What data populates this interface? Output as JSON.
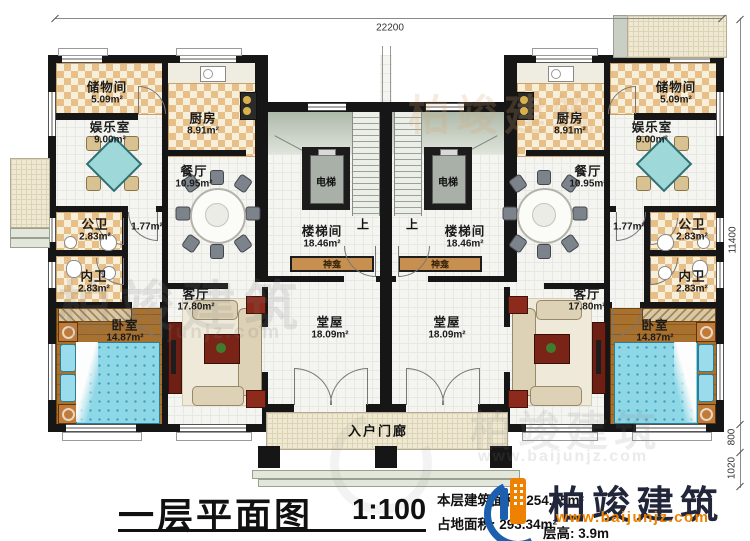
{
  "plan": {
    "dim_width": "22200",
    "dim_height": "11400",
    "dim_800": "800",
    "dim_1020": "1020",
    "rooms": {
      "storage": {
        "name": "储物间",
        "area": "5.09m²"
      },
      "entertainment": {
        "name": "娱乐室",
        "area": "9.00m²"
      },
      "kitchen": {
        "name": "厨房",
        "area": "8.91m²"
      },
      "dining": {
        "name": "餐厅",
        "area": "10.95m²"
      },
      "public_bath": {
        "name": "公卫",
        "area": "2.83m²"
      },
      "hallway": {
        "area": "1.77m²"
      },
      "private_bath": {
        "name": "内卫",
        "area": "2.83m²"
      },
      "bedroom": {
        "name": "卧室",
        "area": "14.87m²"
      },
      "living": {
        "name": "客厅",
        "area": "17.80m²"
      },
      "main_hall": {
        "name": "堂屋",
        "area": "18.09m²"
      },
      "stairwell": {
        "name": "楼梯间",
        "area": "18.46m²"
      },
      "elevator": {
        "name": "电梯"
      },
      "shrine": {
        "name": "神龛"
      },
      "up": {
        "label": "上"
      },
      "porch": {
        "name": "入户门廊"
      }
    }
  },
  "titleblock": {
    "title": "一层平面图",
    "scale": "1:100",
    "floor_area_label": "本层建筑面积:",
    "floor_area_value": "254.95m²",
    "land_area_label": "占地面积:",
    "land_area_value": "293.34m²",
    "floor_height_label": "层高:",
    "floor_height_value": "3.9m",
    "brand": "柏竣建筑",
    "website": "www.baijunjz.com"
  },
  "watermark": {
    "brand": "柏竣建筑",
    "site": "www.baijunjz.com"
  },
  "colors": {
    "wall": "#161616",
    "checker_tan": "#e7c089",
    "brand_blue": "#1c5fae",
    "brand_orange": "#ee8200",
    "bed_teal": "#8ed7e6",
    "accent_red": "#8c2a1c"
  }
}
